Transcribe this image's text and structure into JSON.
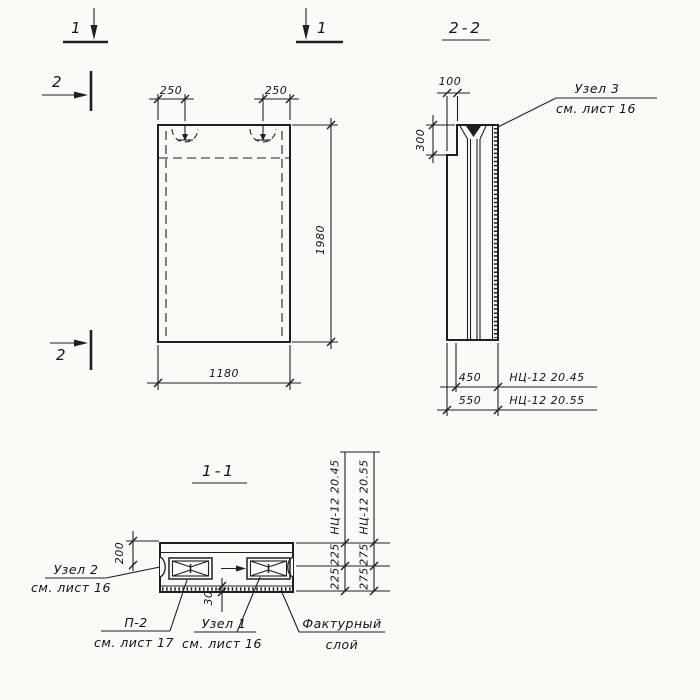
{
  "page": {
    "background": "#fbfaf7",
    "ink": "#1f1f1f"
  },
  "markers": {
    "sec1_left": "1",
    "sec1_right": "1",
    "sec2_top": "2",
    "sec2_bottom": "2"
  },
  "front_view": {
    "dim_loop_left": "250",
    "dim_loop_right": "250",
    "dim_height": "1980",
    "dim_width": "1180"
  },
  "side_view": {
    "title": "2-2",
    "dim_top": "100",
    "dim_step": "300",
    "dim_450": "450",
    "dim_550": "550",
    "mark_450": "НЦ-12 20.45",
    "mark_550": "НЦ-12 20.55",
    "node3_line1": "Узел 3",
    "node3_line2": "см. лист 16"
  },
  "section_view": {
    "title": "1-1",
    "dim_200": "200",
    "dim_30": "30",
    "col45_mark": "НЦ-12 20.45",
    "col45_d1": "225",
    "col45_d2": "225",
    "col55_mark": "НЦ-12 20.55",
    "col55_d1": "275",
    "col55_d2": "275",
    "node2_line1": "Узел 2",
    "node2_line2": "см. лист 16",
    "p2_line1": "П-2",
    "p2_line2": "см. лист 17",
    "node1_line1": "Узел 1",
    "node1_line2": "см. лист 16",
    "factur_line1": "Фактурный",
    "factur_line2": "слой"
  }
}
